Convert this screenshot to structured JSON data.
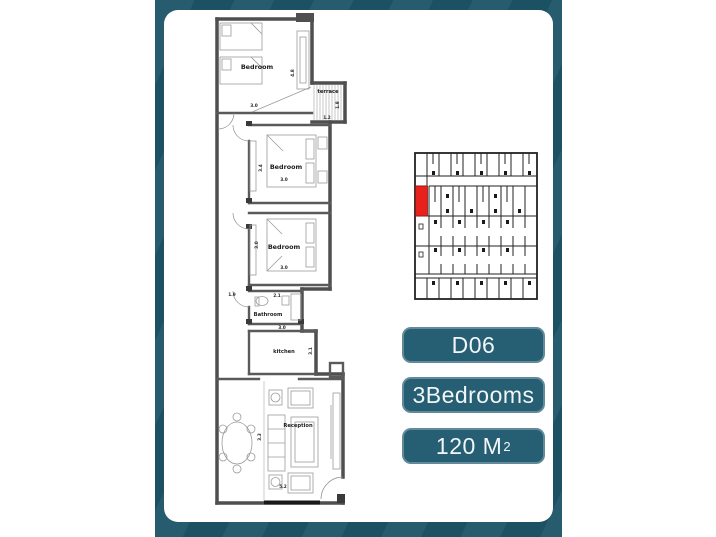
{
  "unit_info": {
    "code": "D06",
    "bedrooms_label": "3Bedrooms",
    "area_value": "120 M",
    "area_sup": "2"
  },
  "floorplan": {
    "bedroom1": {
      "label": "Bedroom",
      "width_dim": "3.0",
      "height_dim": "4.8"
    },
    "terrace": {
      "label": "terrace",
      "width_dim": "1.2",
      "height_dim": "1.8"
    },
    "bedroom2": {
      "label": "Bedroom",
      "width_dim": "3.0",
      "height_dim": "3.4"
    },
    "bedroom3": {
      "label": "Bedroom",
      "width_dim": "3.0",
      "height_dim": "3.0"
    },
    "bathroom": {
      "label": "Bathroom",
      "width_dim": "2.1"
    },
    "hall": {
      "width_dim": "1.9"
    },
    "kitchen": {
      "label": "kitchen",
      "width_dim": "3.0",
      "height_dim": "3.1"
    },
    "reception": {
      "label": "Reception",
      "width_dim": "5.2",
      "height_dim": "3.3"
    }
  },
  "keyplan": {
    "description": "building key plan with highlighted unit",
    "highlight_color": "#e8211d"
  },
  "colors": {
    "backdrop_teal": "#1d5468",
    "badge_teal": "#265e73",
    "card_white": "#ffffff",
    "wall_gray": "#4f4f4f",
    "highlight_red": "#e8211d"
  }
}
